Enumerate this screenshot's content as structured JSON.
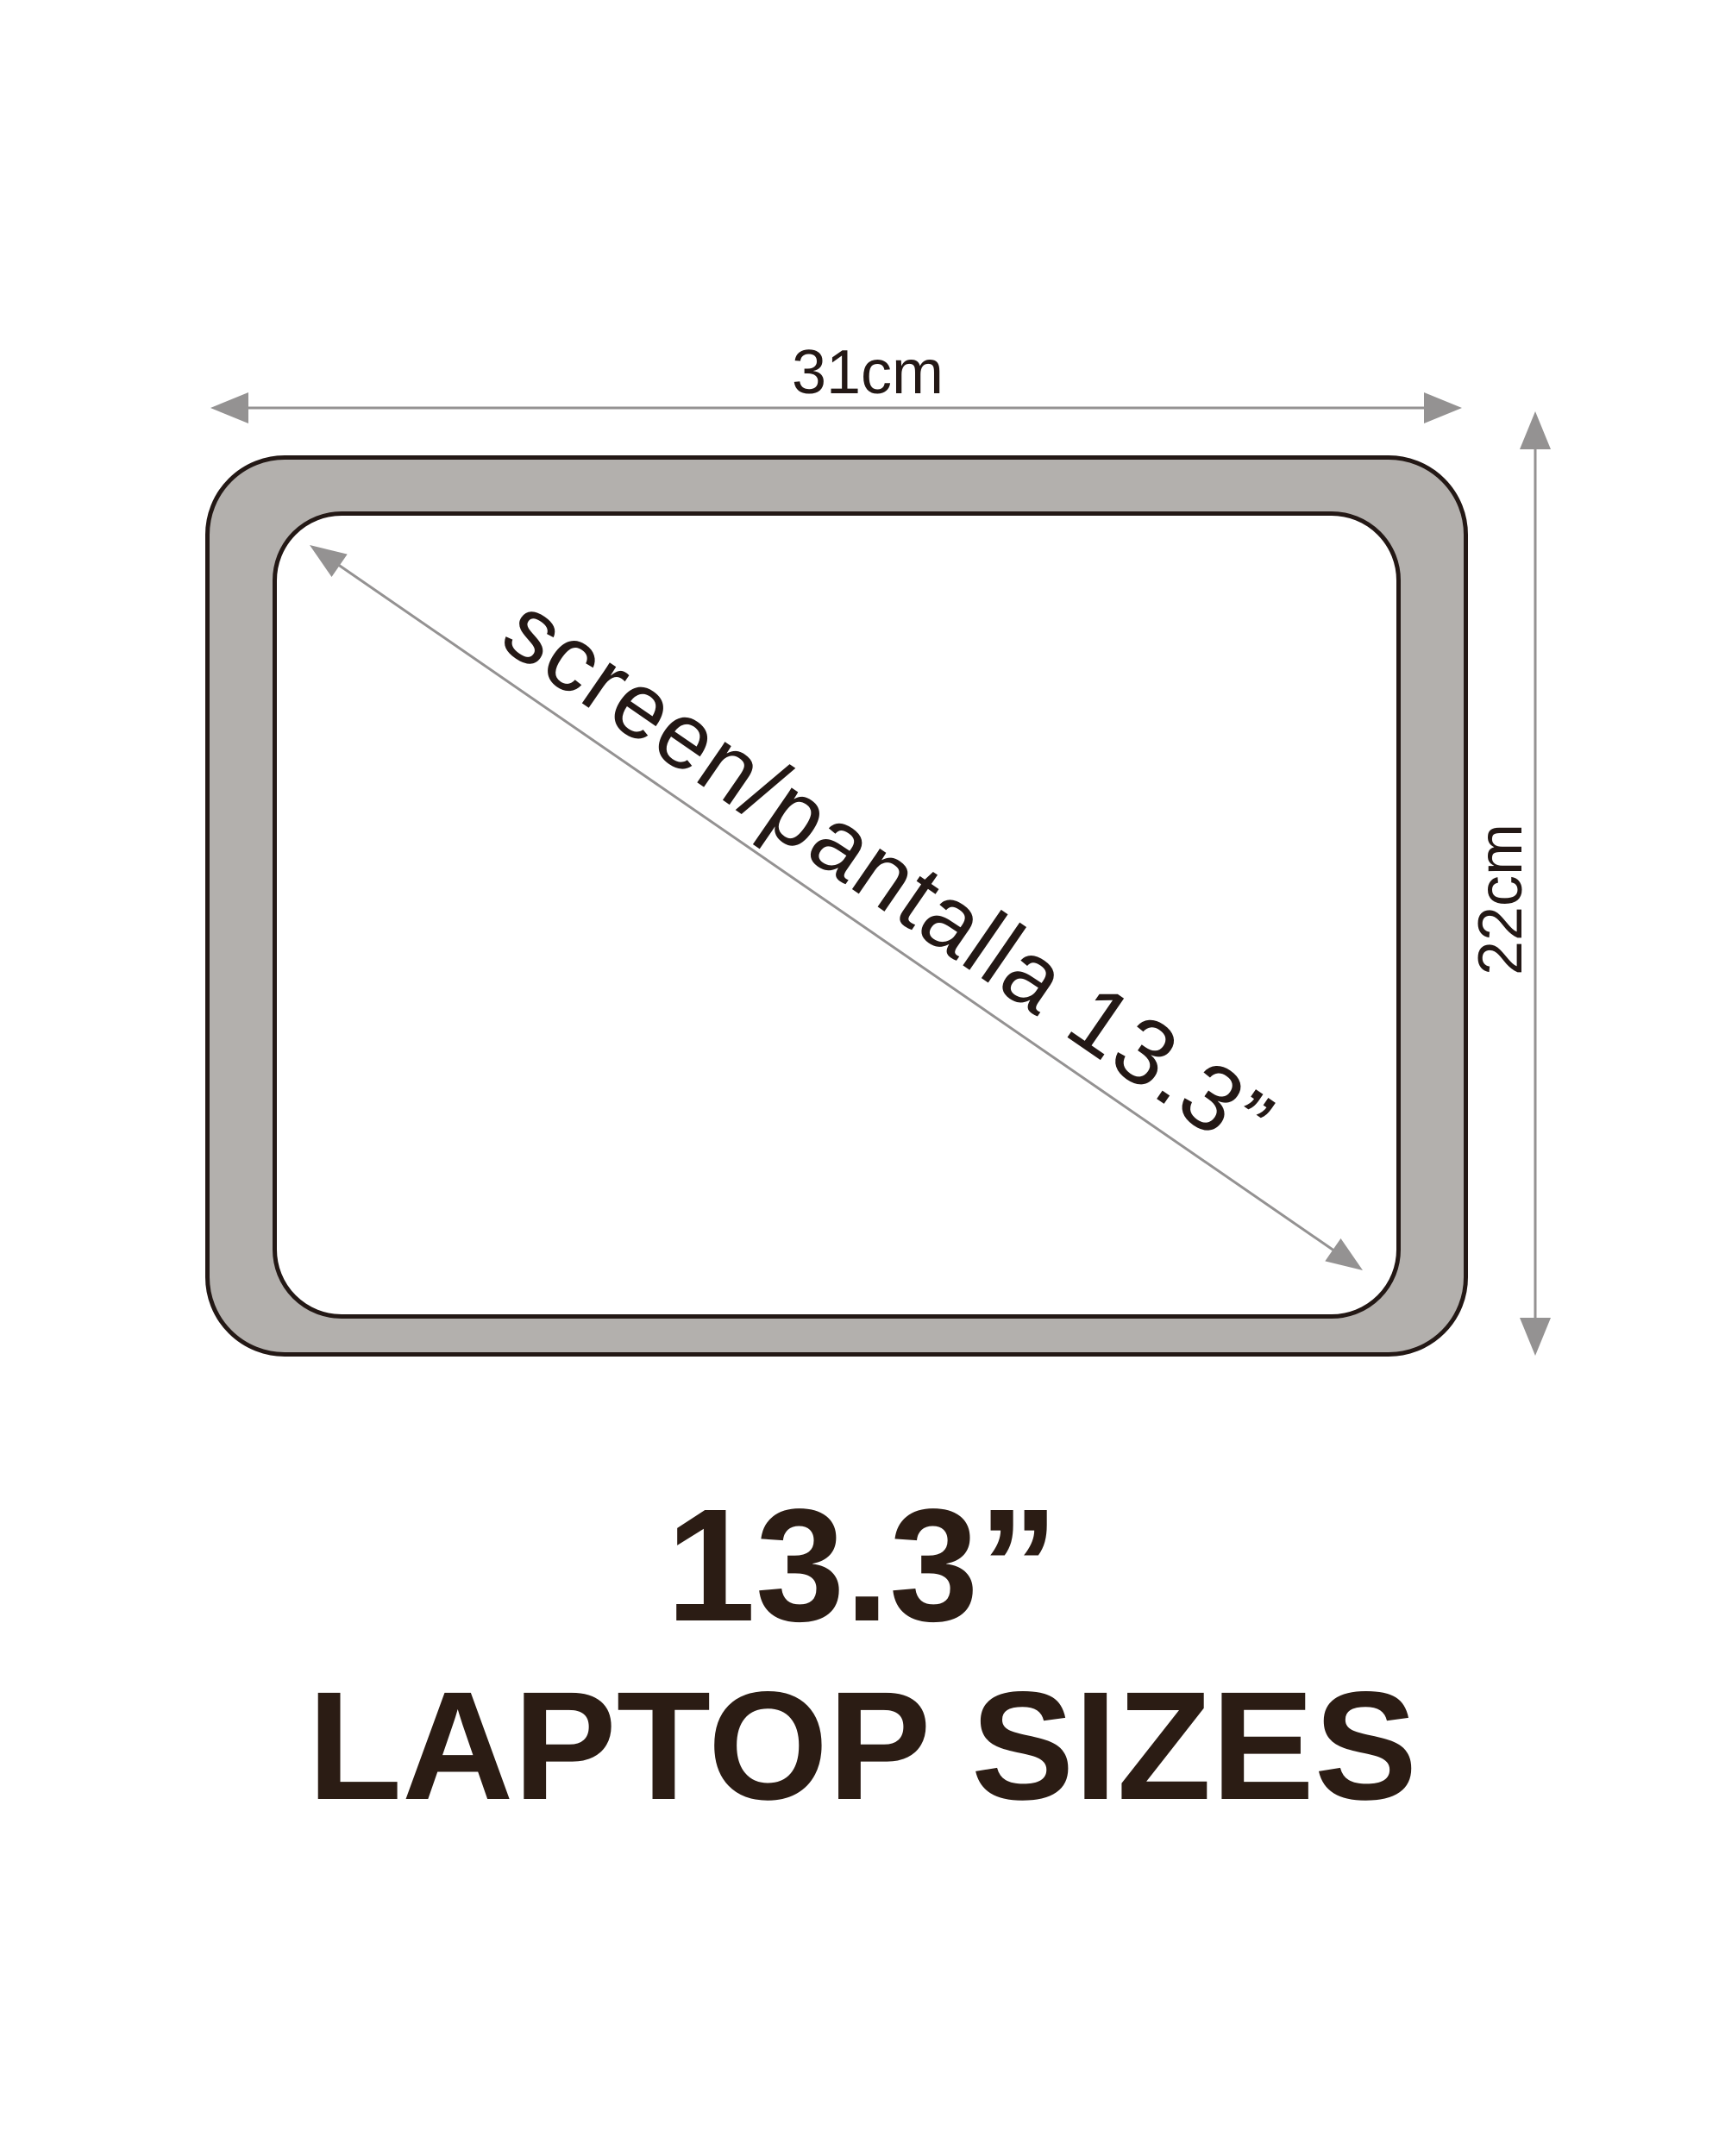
{
  "figure": {
    "width_label": "31cm",
    "height_label": "22cm",
    "diagonal_label": "screen/pantalla 13.3”",
    "caption": {
      "line1": "13.3”",
      "line2": "LAPTOP SIZES"
    }
  },
  "colors": {
    "background": "#ffffff",
    "bezel_fill": "#b3b0ad",
    "screen_fill": "#ffffff",
    "outline": "#231815",
    "arrow": "#949292",
    "label_text": "#231815",
    "caption_text": "#2b1c14"
  }
}
